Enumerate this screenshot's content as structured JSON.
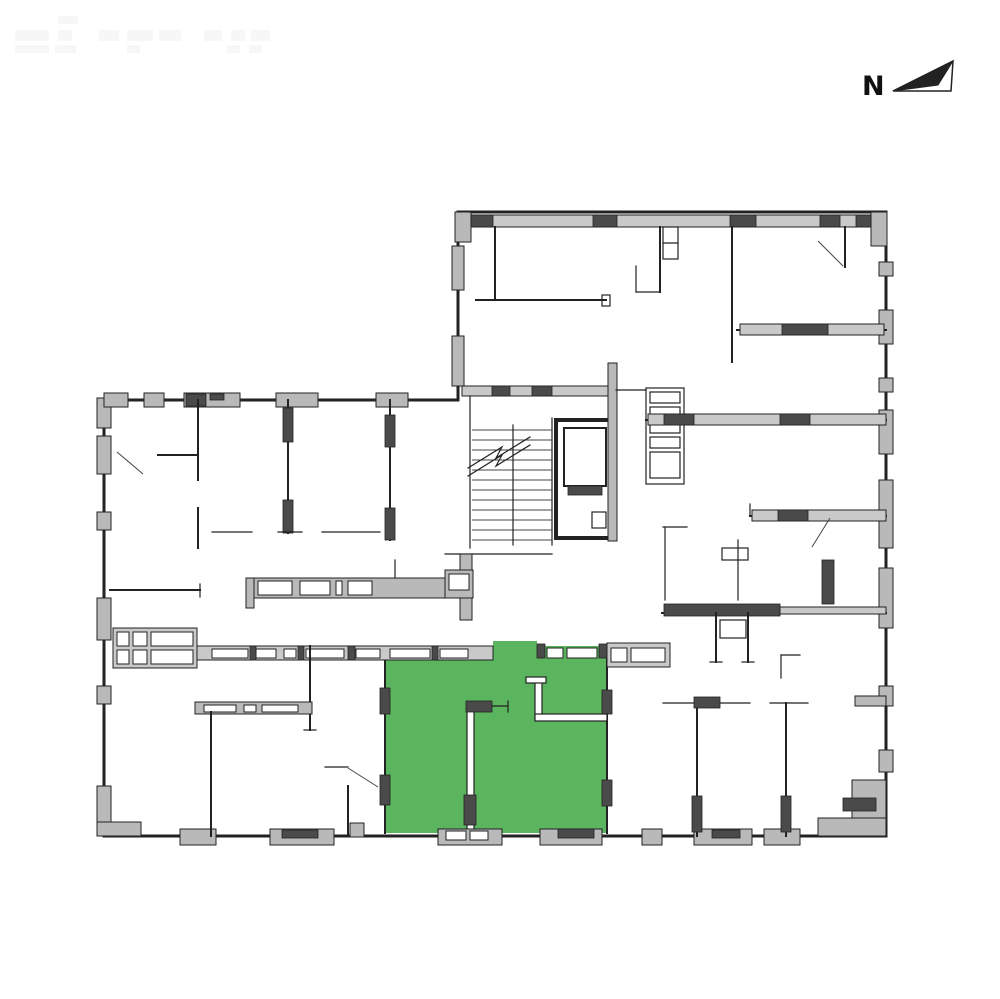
{
  "north_indicator": {
    "label": "N"
  },
  "colors": {
    "background": "#ffffff",
    "unit_highlight": "#5ab55e",
    "walls": "#222222",
    "pier_light": "#b9b9b9",
    "pier_dark": "#4a4a4a",
    "window_fill": "#c9c9c9",
    "watermark": "#f7f7f7"
  },
  "floor_plan": {
    "highlighted_units_count": "1"
  }
}
